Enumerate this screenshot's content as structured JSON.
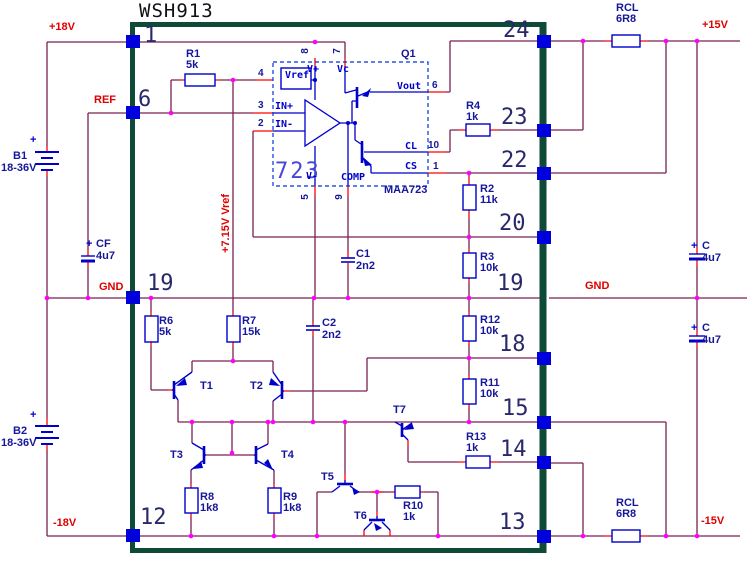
{
  "title": "WSH913",
  "nets": {
    "p18v": "+18V",
    "ref": "REF",
    "gnd_left": "GND",
    "n18v": "-18V",
    "p15v": "+15V",
    "gnd_right": "GND",
    "n15v": "-15V",
    "vref_rail": "+7.15V Vref"
  },
  "module_pins": {
    "left": [
      "1",
      "6",
      "19",
      "12"
    ],
    "right": [
      "24",
      "23",
      "22",
      "20",
      "19",
      "18",
      "15",
      "14",
      "13"
    ]
  },
  "components": {
    "R1": {
      "ref": "R1",
      "value": "5k"
    },
    "R2": {
      "ref": "R2",
      "value": "11k"
    },
    "R3": {
      "ref": "R3",
      "value": "10k"
    },
    "R4": {
      "ref": "R4",
      "value": "1k"
    },
    "R6": {
      "ref": "R6",
      "value": "5k"
    },
    "R7": {
      "ref": "R7",
      "value": "15k"
    },
    "R8": {
      "ref": "R8",
      "value": "1k8"
    },
    "R9": {
      "ref": "R9",
      "value": "1k8"
    },
    "R10": {
      "ref": "R10",
      "value": "1k"
    },
    "R11": {
      "ref": "R11",
      "value": "10k"
    },
    "R12": {
      "ref": "R12",
      "value": "10k"
    },
    "R13": {
      "ref": "R13",
      "value": "1k"
    },
    "RCL_TOP": {
      "ref": "RCL",
      "value": "6R8"
    },
    "RCL_BOTTOM": {
      "ref": "RCL",
      "value": "6R8"
    },
    "C1": {
      "ref": "C1",
      "value": "2n2"
    },
    "C2": {
      "ref": "C2",
      "value": "2n2"
    },
    "CF": {
      "ref": "CF",
      "value": "4u7"
    },
    "C_TOP": {
      "ref": "C",
      "value": "4u7"
    },
    "C_BOTTOM": {
      "ref": "C",
      "value": "4u7"
    },
    "B1": {
      "ref": "B1",
      "value": "18-36V"
    },
    "B2": {
      "ref": "B2",
      "value": "18-36V"
    }
  },
  "transistors": {
    "T1": "T1",
    "T2": "T2",
    "T3": "T3",
    "T4": "T4",
    "T5": "T5",
    "T6": "T6",
    "T7": "T7"
  },
  "ic": {
    "big": "723",
    "part": "MAA723",
    "q1": "Q1",
    "pins": {
      "vref": "Vref",
      "vplus": "V+",
      "vc": "Vc",
      "vminus": "V-",
      "comp": "COMP",
      "inplus": "IN+",
      "inminus": "IN-",
      "vout": "Vout",
      "cl": "CL",
      "cs": "CS"
    },
    "pin_numbers": {
      "p8": "8",
      "p7": "7",
      "p4": "4",
      "p3": "3",
      "p2": "2",
      "p5": "5",
      "p9": "9",
      "p6": "6",
      "p10": "10",
      "p1": "1"
    }
  },
  "symbols": {
    "plus": "+"
  },
  "colors": {
    "wire": "#7a2150",
    "stub": "#ff0000",
    "component_blue": "#0000cc",
    "junction": "#ff00ff",
    "border_green": "#0d4a38",
    "label_red": "#e00000",
    "label_navy": "#16169b",
    "pin_square": "#0000dd"
  }
}
